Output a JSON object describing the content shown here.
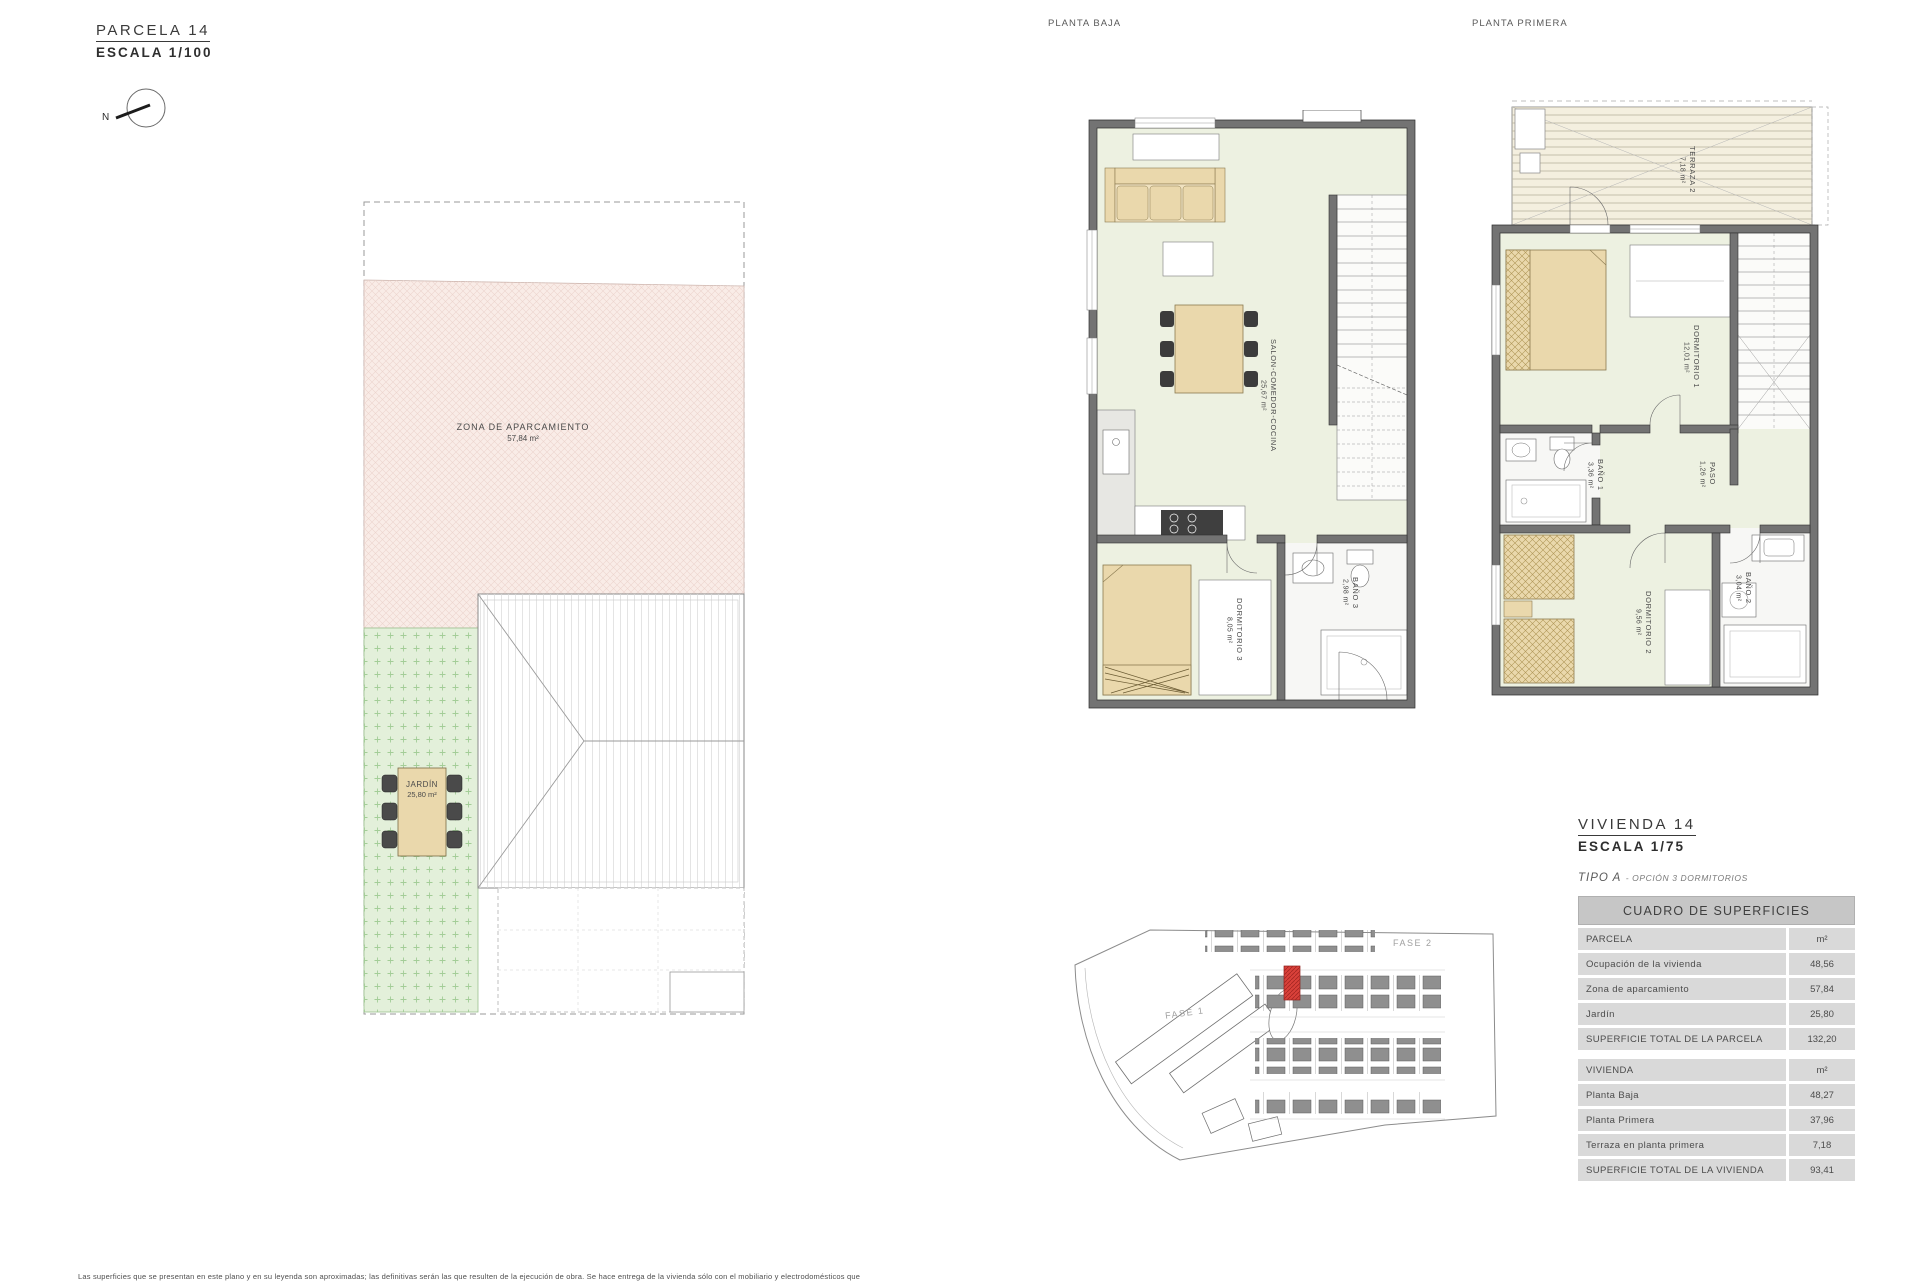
{
  "parcela": {
    "title": "PARCELA 14",
    "scale": "ESCALA 1/100",
    "north": "N",
    "parking_name": "ZONA DE APARCAMIENTO",
    "parking_area": "57,84 m²",
    "garden_name": "JARDÍN",
    "garden_area": "25,80 m²"
  },
  "planta_baja": {
    "title": "PLANTA BAJA",
    "rooms": [
      {
        "name": "SALON-COMEDOR-COCINA",
        "area": "25,67 m²"
      },
      {
        "name": "DORMITORIO 3",
        "area": "8,05 m²"
      },
      {
        "name": "BAÑO 3",
        "area": "2,98 m²"
      }
    ]
  },
  "planta_primera": {
    "title": "PLANTA PRIMERA",
    "rooms": [
      {
        "name": "TERRAZA 2",
        "area": "7,18 m²"
      },
      {
        "name": "DORMITORIO 1",
        "area": "12,01 m²"
      },
      {
        "name": "BAÑO 1",
        "area": "3,36 m²"
      },
      {
        "name": "PASO",
        "area": "1,26 m²"
      },
      {
        "name": "DORMITORIO 2",
        "area": "9,56 m²"
      },
      {
        "name": "BAÑO 2",
        "area": "3,04 m²"
      }
    ]
  },
  "vivienda": {
    "title": "VIVIENDA 14",
    "scale": "ESCALA 1/75",
    "tipo": "TIPO A",
    "tipo_option": "- OPCIÓN 3 DORMITORIOS"
  },
  "site_map": {
    "fase1": "FASE 1",
    "fase2": "FASE 2"
  },
  "table": {
    "header": "CUADRO DE SUPERFICIES",
    "sections": [
      {
        "rows": [
          {
            "label": "PARCELA",
            "value": "m²"
          },
          {
            "label": "Ocupación de la vivienda",
            "value": "48,56"
          },
          {
            "label": "Zona de aparcamiento",
            "value": "57,84"
          },
          {
            "label": "Jardín",
            "value": "25,80"
          },
          {
            "label": "SUPERFICIE TOTAL DE LA PARCELA",
            "value": "132,20"
          }
        ]
      },
      {
        "rows": [
          {
            "label": "VIVIENDA",
            "value": "m²"
          },
          {
            "label": "Planta Baja",
            "value": "48,27"
          },
          {
            "label": "Planta Primera",
            "value": "37,96"
          },
          {
            "label": "Terraza en planta primera",
            "value": "7,18"
          },
          {
            "label": "SUPERFICIE TOTAL DE LA VIVIENDA",
            "value": "93,41"
          }
        ]
      }
    ]
  },
  "footer": {
    "disclaimer": "Las superficies que se presentan en este plano y en su leyenda son aproximadas; las definitivas serán las que resulten de la ejecución de obra. Se hace entrega de la vivienda sólo con el mobiliario y electrodomésticos que"
  }
}
